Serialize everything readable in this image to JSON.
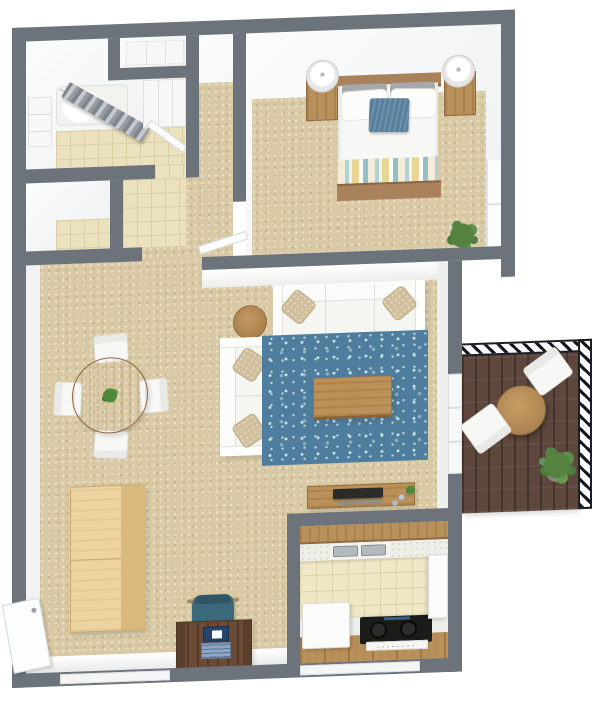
{
  "scene": {
    "type": "3d-floor-plan-render",
    "view": "top-down",
    "description": "One-bedroom apartment 3D floor plan with balcony"
  },
  "palette": {
    "background": "#ffffff",
    "wall": "#6d737b",
    "wall_face": "#f5f6f7",
    "carpet": "#d9caa5",
    "bath_tile": "#ece1bd",
    "kitchen_tile": "#f0e7c6",
    "rug_blue": "#4e7d9e",
    "wood_mid": "#b8905a",
    "wood_light": "#ecd3a0",
    "wood_dark": "#6b4b36",
    "balcony_deck": "#5d463c",
    "accent_teal": "#567f9b",
    "stove_black": "#1b1b19"
  },
  "rooms": [
    {
      "name": "Bathroom",
      "floor": "tile",
      "items": [
        "bathtub",
        "shower-curtain",
        "curtain-rod",
        "vanity-cabinet",
        "shelf-unit",
        "bathroom-door"
      ]
    },
    {
      "name": "Closet",
      "floor": "tile",
      "items": []
    },
    {
      "name": "Entry Hall",
      "floor": "tile",
      "items": [
        "hall-closet-alcove"
      ]
    },
    {
      "name": "Hallway",
      "floor": "carpet",
      "items": [
        "bedroom-door"
      ]
    },
    {
      "name": "Bedroom",
      "floor": "carpet",
      "items": [
        "double-bed",
        "headboard",
        "gray-pillow x2",
        "white-pillow x2",
        "accent-pillow",
        "striped-blanket",
        "footboard",
        "nightstand x2",
        "table-lamp x2",
        "potted-plant",
        "window"
      ]
    },
    {
      "name": "Living / Dining",
      "floor": "carpet",
      "items": [
        "round-dining-table",
        "dining-chair x4",
        "centerpiece-plant",
        "sectional-sofa",
        "throw-pillow x4",
        "side-table",
        "area-rug",
        "coffee-table",
        "storage-cabinet",
        "desk",
        "desk-chair",
        "laptop",
        "tv-console",
        "tv",
        "soundbar",
        "entry-door",
        "window-sill"
      ]
    },
    {
      "name": "Kitchen",
      "floor": "tile",
      "items": [
        "upper-cabinets",
        "countertop",
        "double-sink",
        "dishwasher",
        "range-stove",
        "base-cabinets",
        "refrigerator"
      ]
    },
    {
      "name": "Balcony",
      "floor": "wood-deck",
      "items": [
        "railing",
        "bistro-table",
        "patio-chair x2",
        "potted-plant",
        "sliding-door"
      ]
    }
  ]
}
